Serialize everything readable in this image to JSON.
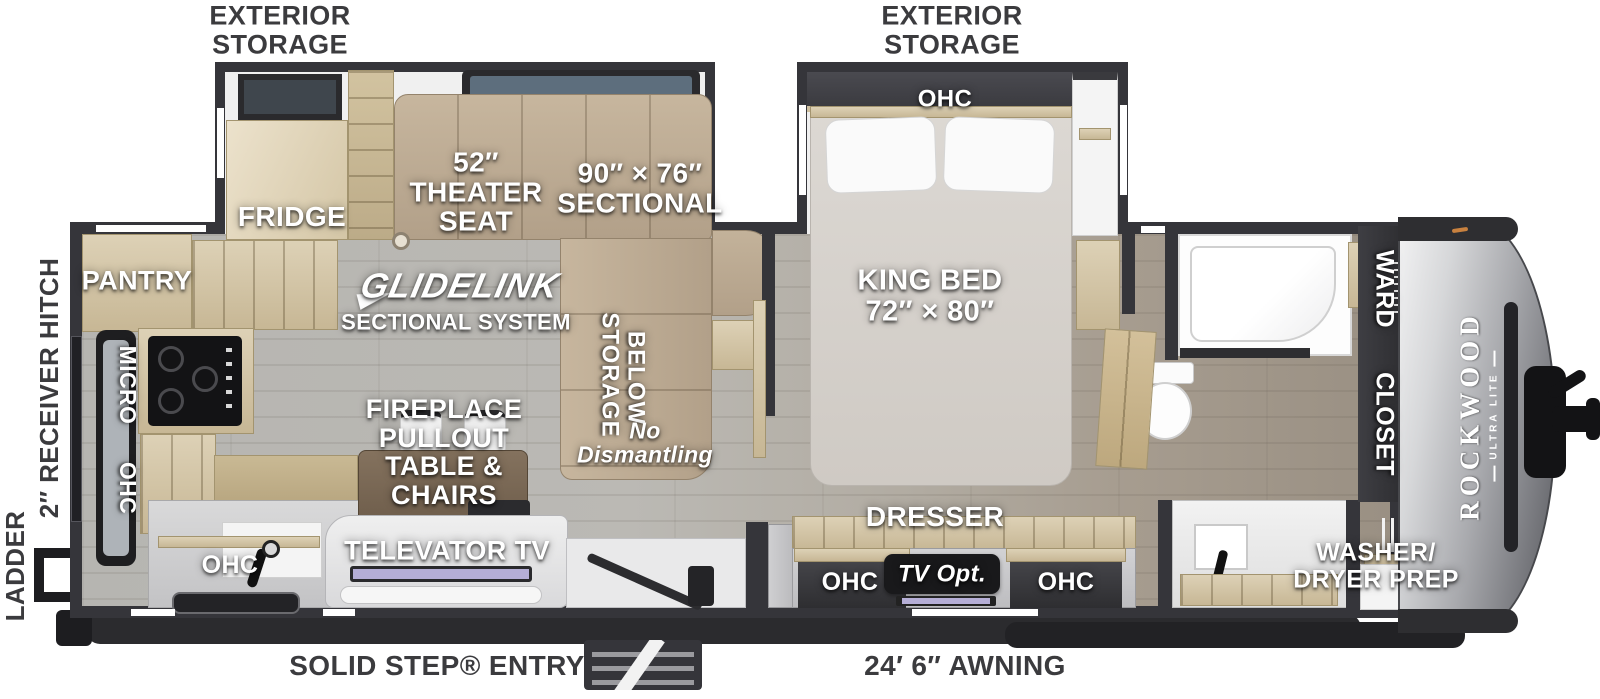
{
  "brand": {
    "name": "ROCKWOOD",
    "sub": "ULTRA LITE"
  },
  "ext": {
    "storage_left": {
      "l1": "EXTERIOR",
      "l2": "STORAGE"
    },
    "storage_right": {
      "l1": "EXTERIOR",
      "l2": "STORAGE"
    },
    "ladder": "LADDER",
    "hitch": "2″ RECEIVER HITCH",
    "entry": "SOLID STEP® ENTRY",
    "awning": "24′ 6″ AWNING"
  },
  "kitchen": {
    "pantry": "PANTRY",
    "fridge": "FRIDGE",
    "micro": "MICRO",
    "ohc_wall": "OHC",
    "ohc_sink": "OHC"
  },
  "living": {
    "theater": {
      "l1": "52″",
      "l2": "THEATER",
      "l3": "SEAT"
    },
    "sectional": {
      "l1": "90″ × 76″",
      "l2": "SECTIONAL"
    },
    "glide": "GLIDELINK",
    "glide_sub": "SECTIONAL SYSTEM",
    "storage_word": "STORAGE",
    "below_word": "BELOW",
    "nodis": {
      "l1": "No",
      "l2": "Dismantling"
    },
    "fire": {
      "l1": "FIREPLACE",
      "l2": "PULLOUT",
      "l3": "TABLE &",
      "l4": "CHAIRS"
    },
    "televator": "TELEVATOR TV"
  },
  "bed": {
    "ohc": "OHC",
    "king": {
      "l1": "KING BED",
      "l2": "72″ × 80″"
    },
    "dresser": "DRESSER",
    "tv_opt": "TV Opt.",
    "ohc_l": "OHC",
    "ohc_r": "OHC"
  },
  "front": {
    "ward": "WARD",
    "closet": "CLOSET",
    "wd": {
      "l1": "WASHER/",
      "l2": "DRYER PREP"
    }
  },
  "colors": {
    "wall": "#35353a",
    "floor": "#b3b1ac",
    "sofa_tan": "#bcab93",
    "cabinet_wood": "#d6c8aa",
    "cap_silver": "#b9babd",
    "label_white": "#ffffff",
    "label_dark": "#3b3b3e",
    "tv_screen": "#b5aed6",
    "window_glass": "#5d6e7d"
  }
}
